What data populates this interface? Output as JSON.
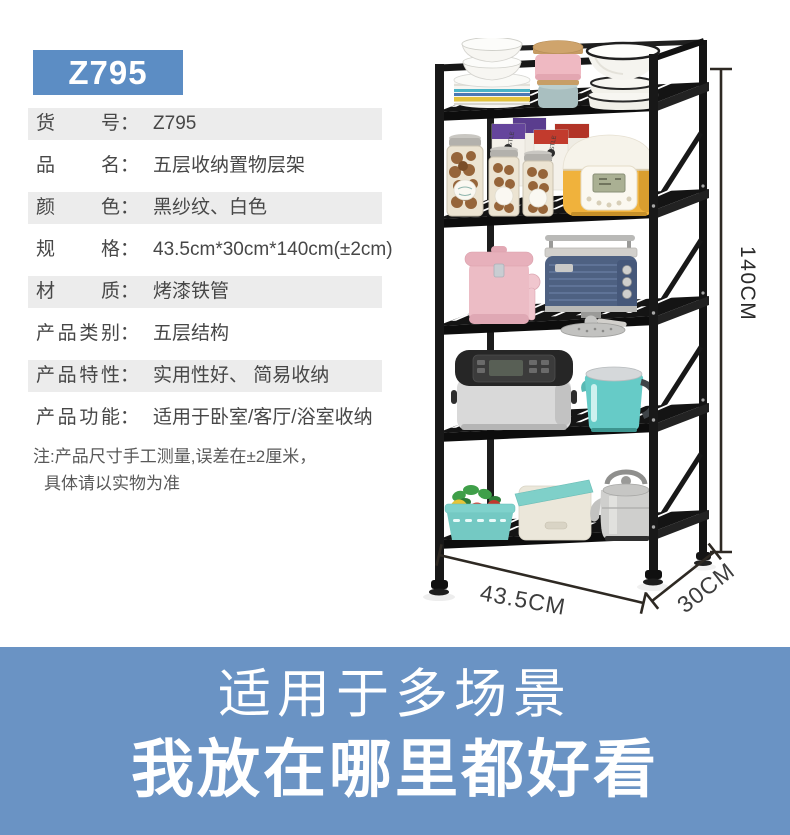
{
  "badge": {
    "text": "Z795"
  },
  "colors": {
    "badge_bg": "#5c8dc4",
    "banner_bg": "#6a93c4",
    "row_shade": "#ececec",
    "frame_black": "#161616"
  },
  "spec_table": {
    "colon": "：",
    "rows": [
      {
        "label": "货号",
        "value": "Z795"
      },
      {
        "label": "品名",
        "value": "五层收纳置物层架"
      },
      {
        "label": "颜色",
        "value": "黑纱纹、白色"
      },
      {
        "label": "规格",
        "value": "43.5cm*30cm*140cm(±2cm)"
      },
      {
        "label": "材质",
        "value": "烤漆铁管"
      },
      {
        "label": "产品类别",
        "value": "五层结构"
      },
      {
        "label": "产品特性",
        "value": "实用性好、 简易收纳"
      },
      {
        "label": "产品功能",
        "value": "适用于卧室/客厅/浴室收纳"
      }
    ]
  },
  "note": {
    "line1": "注:产品尺寸手工测量,误差在±2厘米，",
    "line2": "具体请以实物为准"
  },
  "product_photo": {
    "height_label": "140CM",
    "width_label": "43.5CM",
    "depth_label": "30CM",
    "box_label": "WILLIAM WHISTLE"
  },
  "banner": {
    "line1": "适用于多场景",
    "line2": "我放在哪里都好看"
  }
}
